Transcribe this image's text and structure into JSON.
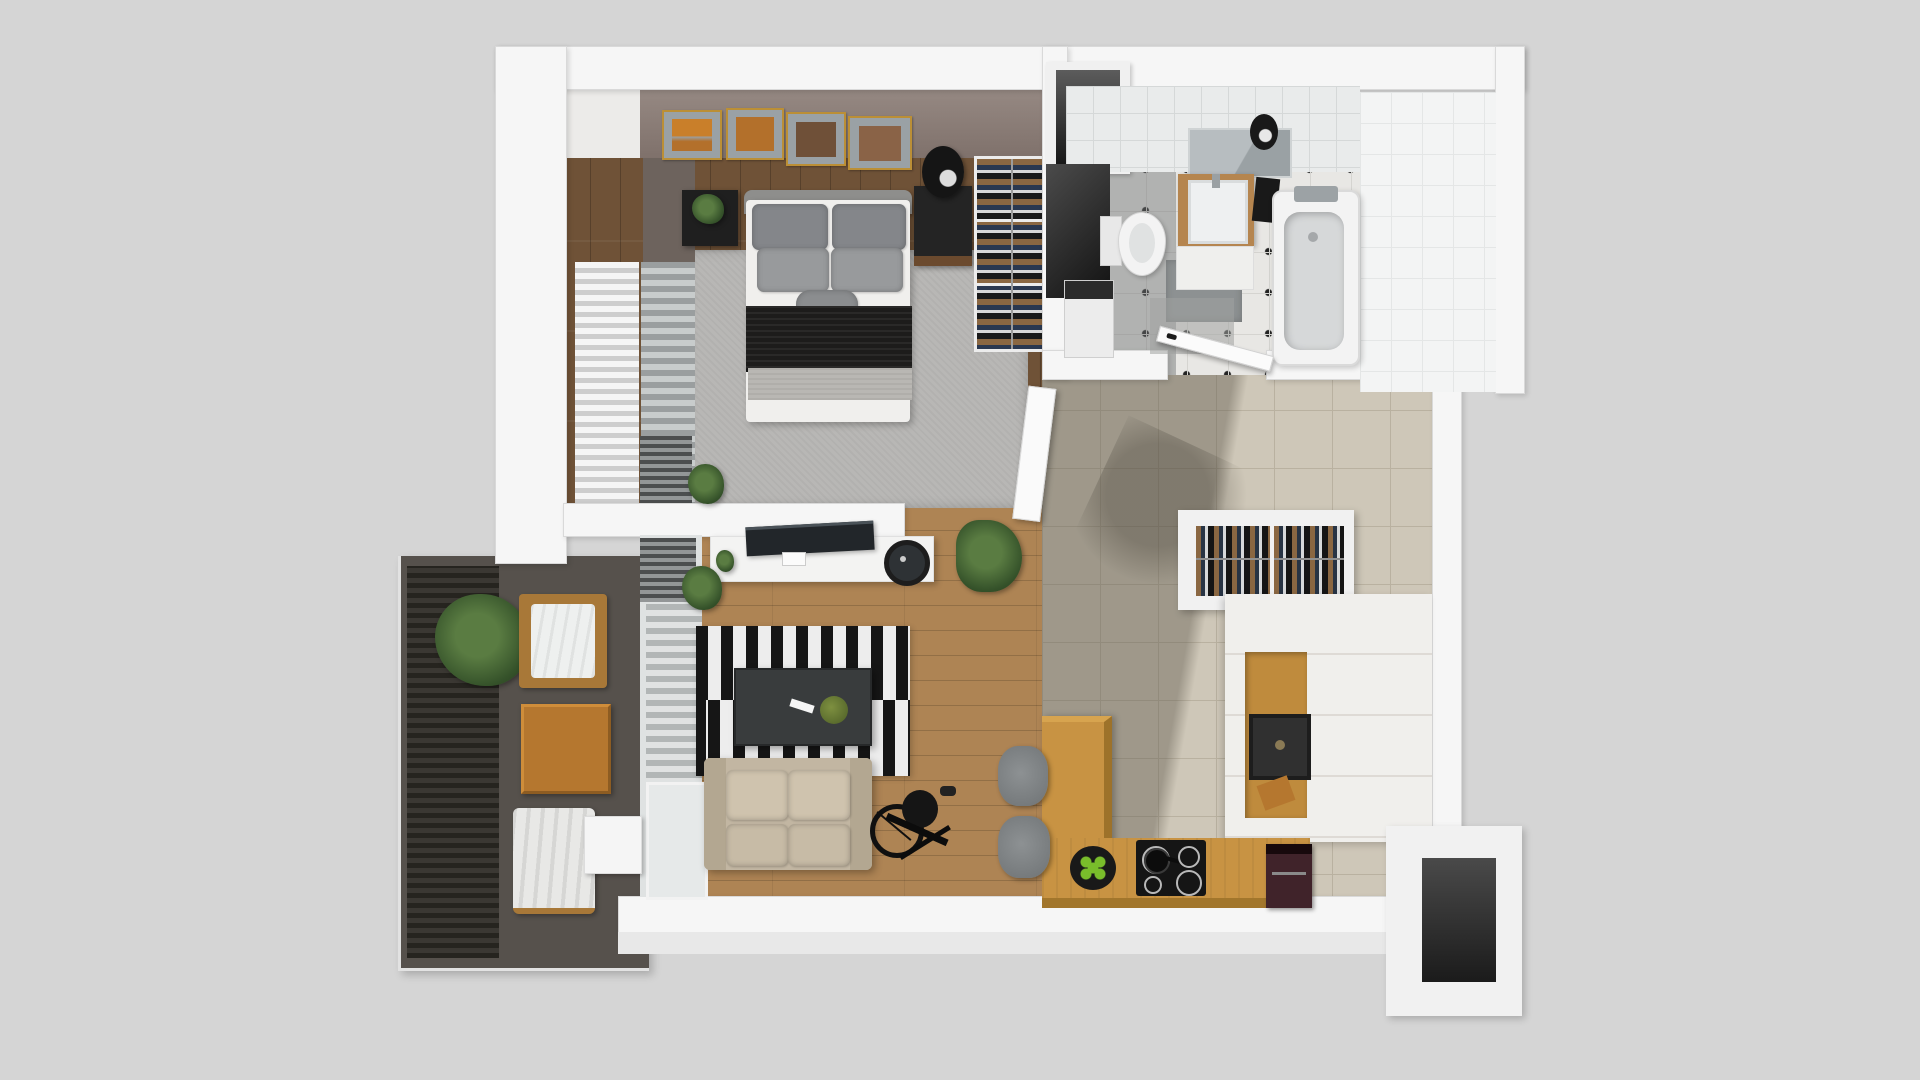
{
  "scene": {
    "kind": "3d-rendered apartment floor plan, top-down view",
    "background": "#d5d5d5"
  },
  "palette": {
    "bg": "#d5d5d5",
    "wall": "#f6f6f6",
    "wallFaceTaupe": "#8b7d77",
    "darkWood": "#6f5237",
    "oakFloor": "#ae8454",
    "tileHall": "#cec7b8",
    "balconyFloor": "#56514c",
    "counterOak": "#c89343",
    "sofaBeige": "#c2b6a2",
    "rugGray": "#b8b7b5",
    "accentGreen": "#79bd2b",
    "frameGold": "#bb8f36"
  },
  "rooms": {
    "bedroom": {
      "label": "Bedroom",
      "furniture": [
        "double bed with gray pillows and black throw",
        "area rug",
        "left nightstand with plant",
        "right nightstand with sphere lamp",
        "open wardrobe with hanging clothes",
        "four gold-framed wall pictures",
        "window blinds",
        "radiator"
      ]
    },
    "bathroom": {
      "label": "Bathroom",
      "furniture": [
        "bathtub with chrome faucet",
        "wood vanity with sink",
        "mirror with sconce",
        "toilet",
        "washing machine",
        "black towel",
        "gray bath mats",
        "black-dot tile floor",
        "open door"
      ]
    },
    "hallway": {
      "label": "Hallway",
      "furniture": [
        "entry wardrobe rack with hanging clothes",
        "beige tile floor",
        "open door to living room"
      ]
    },
    "living_room": {
      "label": "Living room",
      "furniture": [
        "white TV sideboard with TV and turntable",
        "black-and-white striped rug",
        "dark coffee table with remote and moss ball",
        "beige two-seat sofa",
        "exercise bike",
        "potted palm",
        "two small potted plants",
        "vertical blinds to balcony"
      ]
    },
    "kitchen": {
      "label": "Kitchen",
      "furniture": [
        "L-shaped oak counter",
        "induction cooktop with pan",
        "tray of green apples",
        "coffee machine",
        "two gray bar stools",
        "tall white cabinet column",
        "oak oven niche with built-in oven",
        "utility recess"
      ]
    },
    "balcony": {
      "label": "Balcony",
      "furniture": [
        "dark slatted deck",
        "potted plant",
        "armchair with white cushion",
        "oak cube side table",
        "lounger with white throw"
      ]
    }
  }
}
